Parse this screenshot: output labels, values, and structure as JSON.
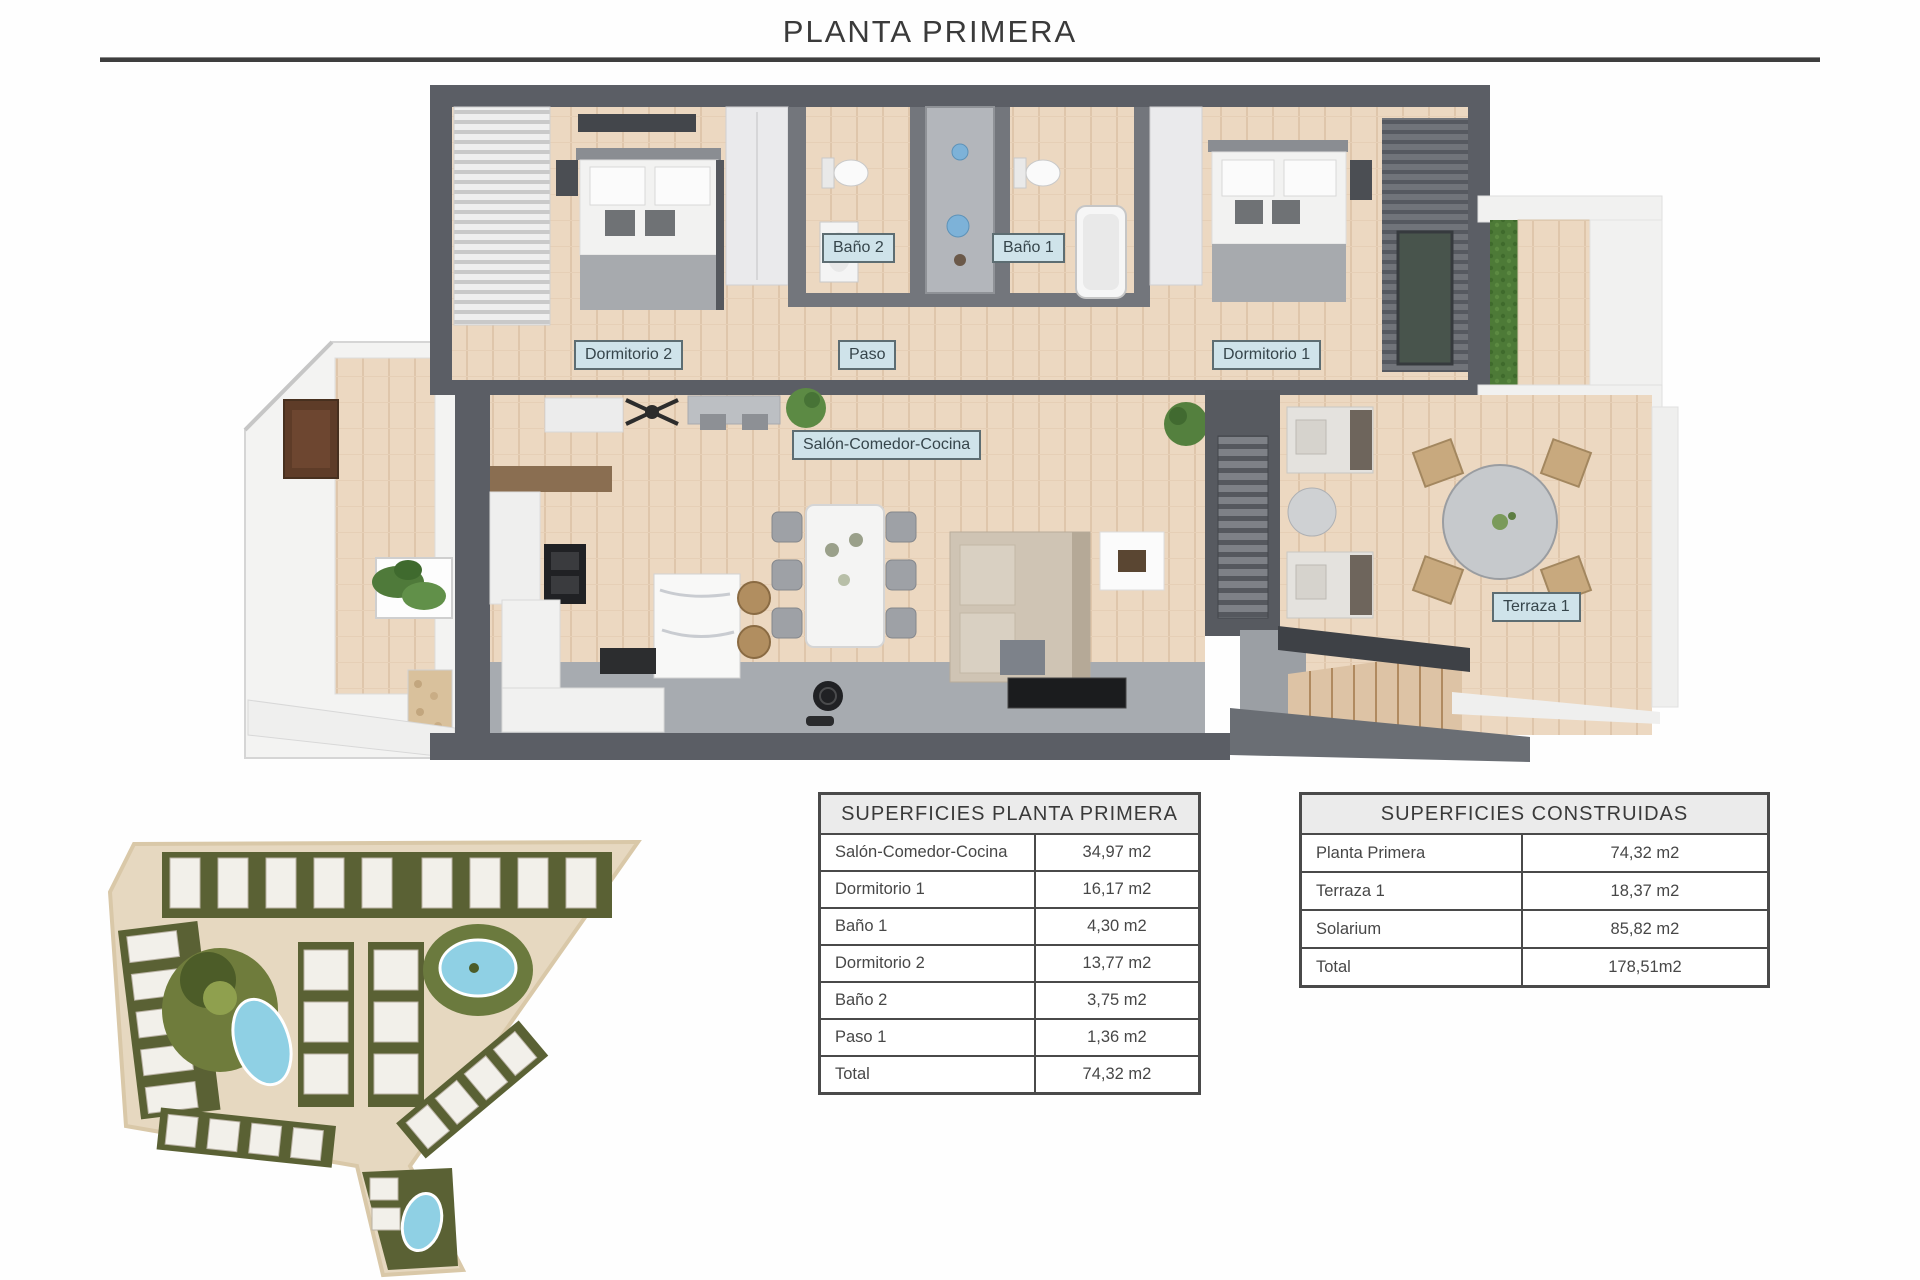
{
  "page": {
    "title": "PLANTA PRIMERA"
  },
  "floor_plan": {
    "labels": {
      "bano2": "Baño 2",
      "bano1": "Baño 1",
      "dormitorio2": "Dormitorio 2",
      "paso": "Paso",
      "dormitorio1": "Dormitorio 1",
      "salon": "Salón-Comedor-Cocina",
      "terraza1": "Terraza 1"
    }
  },
  "tables": {
    "superficies_planta_primera": {
      "title": "SUPERFICIES PLANTA PRIMERA",
      "rows": [
        {
          "label": "Salón-Comedor-Cocina",
          "value": "34,97 m2"
        },
        {
          "label": "Dormitorio 1",
          "value": "16,17 m2"
        },
        {
          "label": "Baño 1",
          "value": "4,30 m2"
        },
        {
          "label": "Dormitorio 2",
          "value": "13,77 m2"
        },
        {
          "label": "Baño 2",
          "value": "3,75 m2"
        },
        {
          "label": "Paso 1",
          "value": "1,36 m2"
        },
        {
          "label": "Total",
          "value": "74,32 m2"
        }
      ]
    },
    "superficies_construidas": {
      "title": "SUPERFICIES CONSTRUIDAS",
      "rows": [
        {
          "label": "Planta Primera",
          "value": "74,32 m2"
        },
        {
          "label": "Terraza 1",
          "value": "18,37 m2"
        },
        {
          "label": "Solarium",
          "value": "85,82 m2"
        },
        {
          "label": "Total",
          "value": "178,51m2"
        }
      ]
    }
  },
  "colors": {
    "label_bg": "#cfe3ea",
    "label_border": "#5d6d72",
    "wall_dark": "#5b5e65",
    "wood_floor": "#ecd8c1",
    "concrete_floor": "#a7abb0",
    "pool_blue": "#8fd0e4",
    "garden_green": "#5a6134",
    "table_border": "#4a4a4a"
  }
}
